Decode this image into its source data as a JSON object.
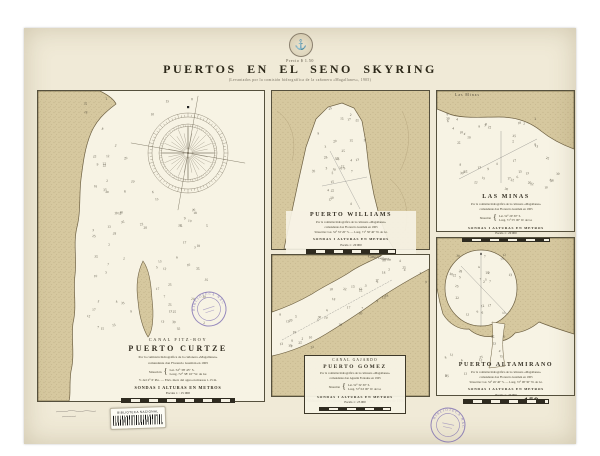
{
  "header": {
    "price": "Precio $ 1.50",
    "title": "PUERTOS EN EL SENO SKYRING",
    "subtitle": "(Levantados por la comisión hidrográfica de la cañonera «Magallanes», 1905)"
  },
  "icons": {
    "seal": "⚓"
  },
  "charts": {
    "curtze": {
      "region": "CANAL FITZ-ROY",
      "title": "PUERTO CURTZE",
      "credit1": "Por la comisión hidrográfica de la cañonera «Magallanes»",
      "credit2": "comandante don Florencio Guzmán en 1905",
      "situacion_label": "Situación",
      "lat": "Lat. 52° 38' 45\" S.",
      "lon": "Long. 72° 38' 10\" W. de Gr.",
      "note": "V. del 2° 6' Pte. — Elev. med. del agua en mareas 1.15 m.",
      "sondas": "SONDAS I ALTURAS EN METROS",
      "escala": "Escala 1 : 15 000"
    },
    "williams": {
      "title": "PUERTO WILLIAMS",
      "credit1": "Por la comisión hidrográfica de la cañonera «Magallanes»",
      "credit2": "comandante don Florencio Guzmán en 1905",
      "situacion": "Situación: Lat. 52° 33' 20\" S. — Long. 71° 58' 40\" W. de Gr.",
      "sondas": "SONDAS I ALTURAS EN METROS",
      "escala": "Escala 1 : 20 000"
    },
    "minas": {
      "title": "LAS MINAS",
      "place_label": "Las Minas",
      "credit1": "Por la comisión hidrográfica de la cañonera «Magallanes»",
      "credit2": "comandante don Florencio Guzmán en 1905",
      "situacion_label": "Situación",
      "lat": "Lat. 52° 29' 30\" S.",
      "lon": "Long. 71° 55' 00\" W. de Gr.",
      "sondas": "SONDAS I ALTURAS EN METROS",
      "escala": "Escala 1 : 20 000"
    },
    "gomez": {
      "region": "CANAL GAJARDO",
      "title": "PUERTO GOMEZ",
      "canal_label": "Canal Gajardo",
      "credit1": "Por la comisión hidrográfica de la cañonera «Magallanes»",
      "credit2": "comandante don Agustín Fontaine en 1905",
      "situacion_label": "Situación",
      "lat": "Lat. 52° 32' 30\" S.",
      "lon": "Long. 72° 04' 00\" W. de Gr.",
      "sondas": "SONDAS I ALTURAS EN METROS",
      "escala": "Escala 1 : 25 000"
    },
    "altamirano": {
      "title": "PUERTO ALTAMIRANO",
      "credit1": "Por la comisión hidrográfica de la cañonera «Magallanes»",
      "credit2": "comandante don Florencio Guzmán en 1905",
      "situacion": "Situación: Lat. 52° 26' 40\" S. — Long. 72° 08' 30\" W. de Gr.",
      "sondas": "SONDAS I ALTURAS EN METROS",
      "escala": "Escala 1 : 20 000"
    }
  },
  "footer": {
    "published": "Publicado por la Oficina Hidrográfica de Chile — Octubre de 1906",
    "workshop": "Taller Topolitográfico de la Armada (Chile.)",
    "sheet_number": "159"
  },
  "stamps": {
    "library_round": "BIBLIOTECA NACIONAL",
    "barcode_label": "BIBLIOTECA NACIONAL"
  },
  "colors": {
    "paper": "#f0ead7",
    "water": "#f7f3e4",
    "land": "#d6c89f",
    "ink": "#2f2b20",
    "stamp": "#6f5fad"
  },
  "soundings": {
    "values": [
      2,
      3,
      4,
      5,
      6,
      7,
      8,
      9,
      10,
      12,
      13,
      15,
      17,
      18,
      20,
      22,
      25,
      28,
      30,
      35
    ]
  }
}
